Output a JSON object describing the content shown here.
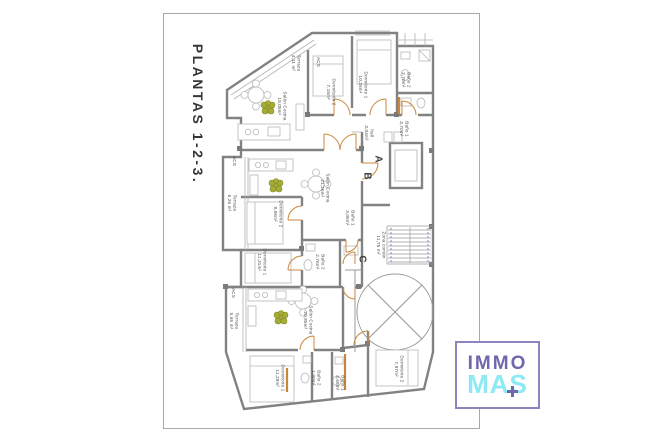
{
  "page": {
    "sheet_title": "PLANTAS 1-2-3."
  },
  "logo": {
    "top": "IMMO",
    "bottom": "MAS",
    "plus_icon": "plus-cross",
    "purple": "#6f68ad",
    "cyan": "#8de9f4",
    "border": "#8a84c0"
  },
  "colors": {
    "wall": "#828282",
    "thin": "#b2b2b2",
    "door": "#c8873c",
    "plant": "#a6ad35",
    "stair_dash": "#6b7fd0"
  },
  "plan": {
    "units": {
      "a": {
        "letter": "A",
        "terraza": "Terraza\n4,11 m²",
        "acs": "ACS",
        "salon": "Salón Cocina\n19,05m²",
        "dorm2": "Dormitorio 2\n7,15m²",
        "dorm1": "Dormitorio 1\n10,36m²",
        "bano2": "Baño 2\n2,70m²",
        "bano1": "Baño 1\n3,70m²",
        "hall": "hall\n3,04m²"
      },
      "b": {
        "letter": "B",
        "acs": "ACS",
        "terraza": "Terraza\n6,26 m²",
        "salon": "Salón Cocina\n21,26m²",
        "dorm2": "Dormitorio 2\n8,06m²",
        "dorm1": "Dormitorio 1\n11,31m²",
        "bano2": "Baño 2\n2,76m²",
        "bano1": "Baño 1\n3,06m²"
      },
      "c": {
        "letter": "C",
        "acs": "ACS",
        "terraza": "Terraza\n5,65 m²",
        "salon": "Salón Cocina\n20,85m²",
        "dorm1": "Dormitorio 1\n11,29m²",
        "bano2": "Baño 2\n1,90m²",
        "bano1": "Baño 1\n3,68m²",
        "dorm2": "Dormitorio 2\n7,97m²"
      }
    },
    "common": {
      "zona": "Zona común\n11,75 m²"
    }
  }
}
